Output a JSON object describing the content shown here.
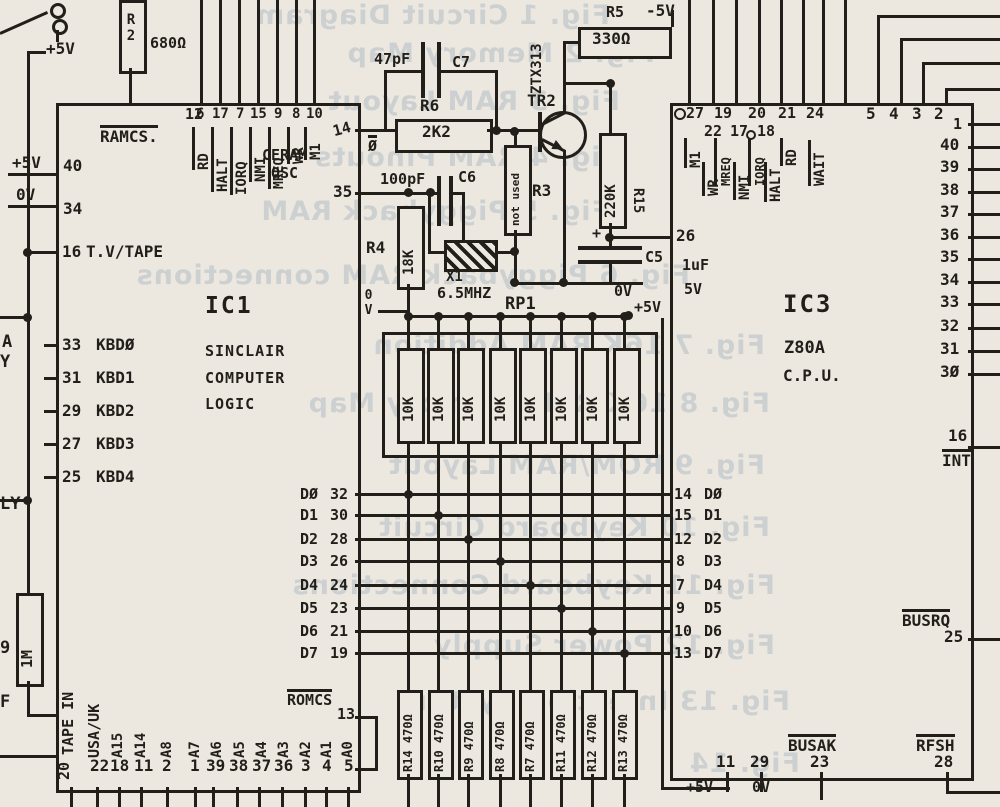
{
  "bleed_lines": [
    "Fig. 1   Circuit Diagram",
    "Fig. 2   Memory Map",
    "Fig. 3   RAM Layout",
    "Fig. 4   RAM Pinouts",
    "Fig. 5   Piggyback RAM",
    "Fig. 6   Piggyback RAM connections",
    "Fig. 7   16K RAM Addition",
    "Fig. 8   16K RAM Memory Map",
    "Fig. 9   ROM/RAM Layout",
    "Fig. 10   Keyboard Circuit",
    "Fig. 11   Keyboard Connections",
    "Fig. 12   Power Supply",
    "Fig. 13   Injection System",
    "Fig. 14"
  ],
  "left_rail": {
    "plus5v": "+5V",
    "r1m": "1M",
    "cut_a": "A",
    "cut_y": "Y",
    "cut_ly": "LY",
    "cut_9": "9",
    "cut_f": "F"
  },
  "ic1": {
    "name": "IC1",
    "line1": "SINCLAIR",
    "line2": "COMPUTER",
    "line3": "LOGIC",
    "pin12": "12",
    "ramcs": "RAMCS.",
    "top_pins": [
      {
        "pin": "6",
        "label": "RD"
      },
      {
        "pin": "17",
        "label": "HALT"
      },
      {
        "pin": "7",
        "label": "IORQ"
      },
      {
        "pin": "15",
        "label": "NMI"
      },
      {
        "pin": "9",
        "label": "MREQ"
      },
      {
        "pin": "8",
        "label": "WR"
      },
      {
        "pin": "10",
        "label": "M1"
      }
    ],
    "pin14": "14",
    "ceram1": "CERAM",
    "ceram2": "OSC",
    "pin35": "35",
    "rail5v": "+5V",
    "pin40": "40",
    "rail0v": "0V",
    "pin34": "34",
    "pin16": "16",
    "tv_tape": "T.V/TAPE",
    "kbd": [
      {
        "pin": "33",
        "label": "KBDØ"
      },
      {
        "pin": "31",
        "label": "KBD1"
      },
      {
        "pin": "29",
        "label": "KBD2"
      },
      {
        "pin": "27",
        "label": "KBD3"
      },
      {
        "pin": "25",
        "label": "KBD4"
      }
    ],
    "dbus": [
      {
        "label": "DØ",
        "pin": "32"
      },
      {
        "label": "D1",
        "pin": "30"
      },
      {
        "label": "D2",
        "pin": "28"
      },
      {
        "label": "D3",
        "pin": "26"
      },
      {
        "label": "D4",
        "pin": "24"
      },
      {
        "label": "D5",
        "pin": "23"
      },
      {
        "label": "D6",
        "pin": "21"
      },
      {
        "label": "D7",
        "pin": "19"
      }
    ],
    "tape_in": "TAPE IN",
    "tape_pin": "20",
    "usa_uk": "USA/UK",
    "usa_pin": "22",
    "addr": [
      {
        "label": "A15",
        "pin": "18"
      },
      {
        "label": "A14",
        "pin": "11"
      },
      {
        "label": "A8",
        "pin": "2"
      },
      {
        "label": "A7",
        "pin": "1"
      },
      {
        "label": "A6",
        "pin": "39"
      },
      {
        "label": "A5",
        "pin": "38"
      },
      {
        "label": "A4",
        "pin": "37"
      },
      {
        "label": "A3",
        "pin": "36"
      },
      {
        "label": "A2",
        "pin": "3"
      },
      {
        "label": "A1",
        "pin": "4"
      },
      {
        "label": "A0",
        "pin": "5"
      }
    ],
    "romcs": "ROMCS",
    "romcs_pin": "13"
  },
  "osc": {
    "r2": "R2",
    "r2_val": "680Ω",
    "c7_val": "47pF",
    "c7": "C7",
    "r6": "R6",
    "r6_val": "2K2",
    "phase": "Ø",
    "tr2": "TR2",
    "tr2_type": "ZTX313",
    "r5": "R5",
    "r5_val": "330Ω",
    "minus5": "-5V",
    "r3": "R3",
    "r3_note": "not used",
    "r15": "R15",
    "r15_val": "220K",
    "c5": "C5",
    "c5_plus": "+",
    "c5_val1": "1uF",
    "c5_val2": "5V",
    "c5_0v": "0V",
    "r4": "R4",
    "r4_val": "18K",
    "r4_0v": "0V",
    "c6_val": "100pF",
    "c6": "C6",
    "x1": "X1",
    "x1_val": "6.5MHZ"
  },
  "rp1": {
    "name": "RP1",
    "plus5": "+5V",
    "values": [
      "10K",
      "10K",
      "10K",
      "10K",
      "10K",
      "10K",
      "10K",
      "10K"
    ]
  },
  "rbank": [
    "R14 470Ω",
    "R10 470Ω",
    "R9 470Ω",
    "R8 470Ω",
    "R7 470Ω",
    "R11 470Ω",
    "R12 470Ω",
    "R13 470Ω"
  ],
  "ic3": {
    "name": "IC3",
    "line1": "Z80A",
    "line2": "C.P.U.",
    "ctrl_row1": [
      "27",
      "19",
      "20",
      "21",
      "24"
    ],
    "ctrl_row2": [
      "22",
      "17",
      "18"
    ],
    "ctrl_labels": [
      "M1",
      "WR",
      "MREQ",
      "NMI",
      "IORQ",
      "HALT",
      "RD",
      "WAIT"
    ],
    "addr_top": [
      "5",
      "4",
      "3",
      "2"
    ],
    "pin1": "1",
    "addr_side": [
      "40",
      "39",
      "38",
      "37",
      "36",
      "35",
      "34",
      "33",
      "32",
      "31",
      "3Ø"
    ],
    "pin26": "26",
    "cap_val1": "1uF",
    "cap_val2": "5V",
    "pin16": "16",
    "int": "INT",
    "busrq": "BUSRQ",
    "pin25": "25",
    "busak": "BUSAK",
    "pin23": "23",
    "rfsh": "RFSH",
    "pin28": "28",
    "pin11": "11",
    "plus5": "+5V",
    "pin29": "29",
    "zero": "0V",
    "dbus": [
      {
        "pin": "14",
        "label": "DØ"
      },
      {
        "pin": "15",
        "label": "D1"
      },
      {
        "pin": "12",
        "label": "D2"
      },
      {
        "pin": "8",
        "label": "D3"
      },
      {
        "pin": "7",
        "label": "D4"
      },
      {
        "pin": "9",
        "label": "D5"
      },
      {
        "pin": "10",
        "label": "D6"
      },
      {
        "pin": "13",
        "label": "D7"
      }
    ]
  }
}
